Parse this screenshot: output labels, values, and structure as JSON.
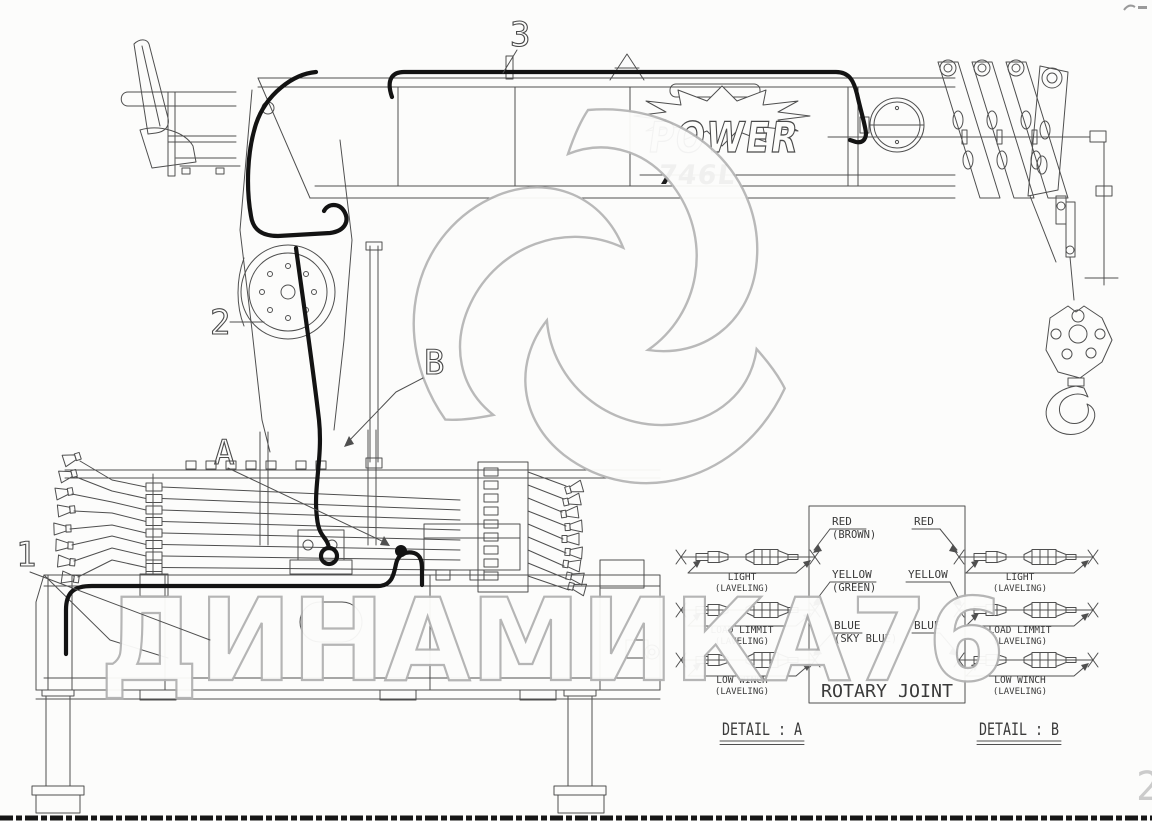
{
  "watermarks": {
    "brand_text": "ДИНАМИКА76",
    "corner_number": "2",
    "color": "#b2b2b2"
  },
  "boom": {
    "logo_text": "POWER",
    "model": "746L"
  },
  "callouts": {
    "n1": "1",
    "n2": "2",
    "n3": "3",
    "a": "A",
    "b": "B"
  },
  "rotary_joint_label": "ROTARY JOINT",
  "detail_a": {
    "title": "DETAIL : A",
    "wire_labels": [
      {
        "main": "RED",
        "sub": "(BROWN)"
      },
      {
        "main": "YELLOW",
        "sub": "(GREEN)"
      },
      {
        "main": "BLUE",
        "sub": "(SKY BLUE)"
      }
    ],
    "connector_labels": [
      {
        "main": "LIGHT",
        "sub": "(LAVELING)"
      },
      {
        "main": "LOAD LIMMIT",
        "sub": "(LAVELING)"
      },
      {
        "main": "LOW WINCH",
        "sub": "(LAVELING)"
      }
    ]
  },
  "detail_b": {
    "title": "DETAIL : B",
    "wire_labels": [
      {
        "main": "RED"
      },
      {
        "main": "YELLOW"
      },
      {
        "main": "BLUE"
      }
    ],
    "connector_labels": [
      {
        "main": "LIGHT",
        "sub": "(LAVELING)"
      },
      {
        "main": "LOAD LIMMIT",
        "sub": "(LAVELING)"
      },
      {
        "main": "LOW WINCH",
        "sub": "(LAVELING)"
      }
    ]
  }
}
